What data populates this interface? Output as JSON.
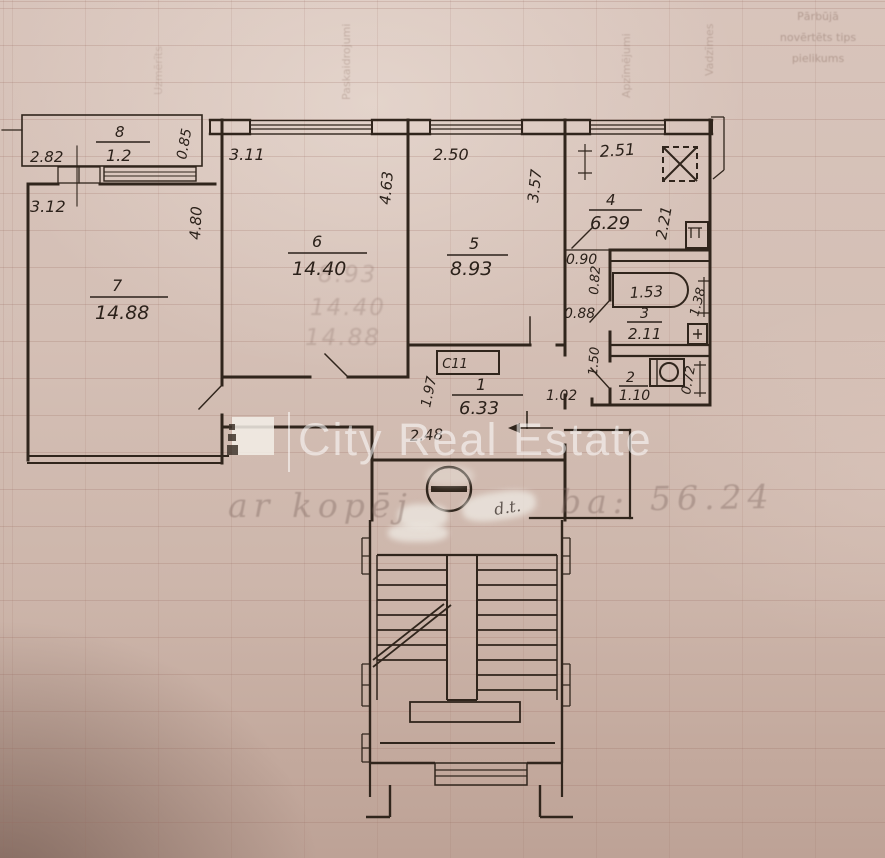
{
  "page": {
    "watermark_brand": "City Real Estate",
    "handwriting": {
      "part1": "ar kopēj",
      "part2": "ba:",
      "part3": "56.24",
      "note": "d.t."
    },
    "faint_form_header": {
      "block_lines": [
        "Pārbūjā",
        "novērtēts tips",
        "pielikums"
      ],
      "column_labels": [
        "Uzmērīts",
        "Paskaidrojumi",
        "Apzīmējumi",
        "Vadzīmes"
      ]
    },
    "ghost_numbers": [
      "8.93",
      "14.40",
      "14.88"
    ]
  },
  "plan": {
    "rooms": {
      "room8": {
        "num": "8",
        "area": "1.2",
        "w": "2.82",
        "d": "0.85"
      },
      "room7": {
        "num": "7",
        "area": "14.88",
        "w": "3.12",
        "h": "4.80"
      },
      "room6": {
        "num": "6",
        "area": "14.40",
        "w": "3.11",
        "h": "4.63"
      },
      "room5": {
        "num": "5",
        "area": "8.93",
        "w": "2.50",
        "h": "3.57"
      },
      "room4": {
        "num": "4",
        "area": "6.29",
        "w": "2.51",
        "h": "2.21"
      },
      "room3": {
        "num": "3",
        "area": "2.11",
        "tub": "1.53",
        "h": "1.38"
      },
      "room2": {
        "num": "2",
        "area": "1.10",
        "h": "0.72"
      },
      "room1": {
        "num": "1",
        "area": "6.33",
        "h": "1.97",
        "w": "2.48",
        "entry": "1.02"
      },
      "vestibule": {
        "a": "0.90",
        "b": "0.82",
        "c": "0.88",
        "d": "1.50"
      },
      "closet_label": "C11"
    }
  }
}
